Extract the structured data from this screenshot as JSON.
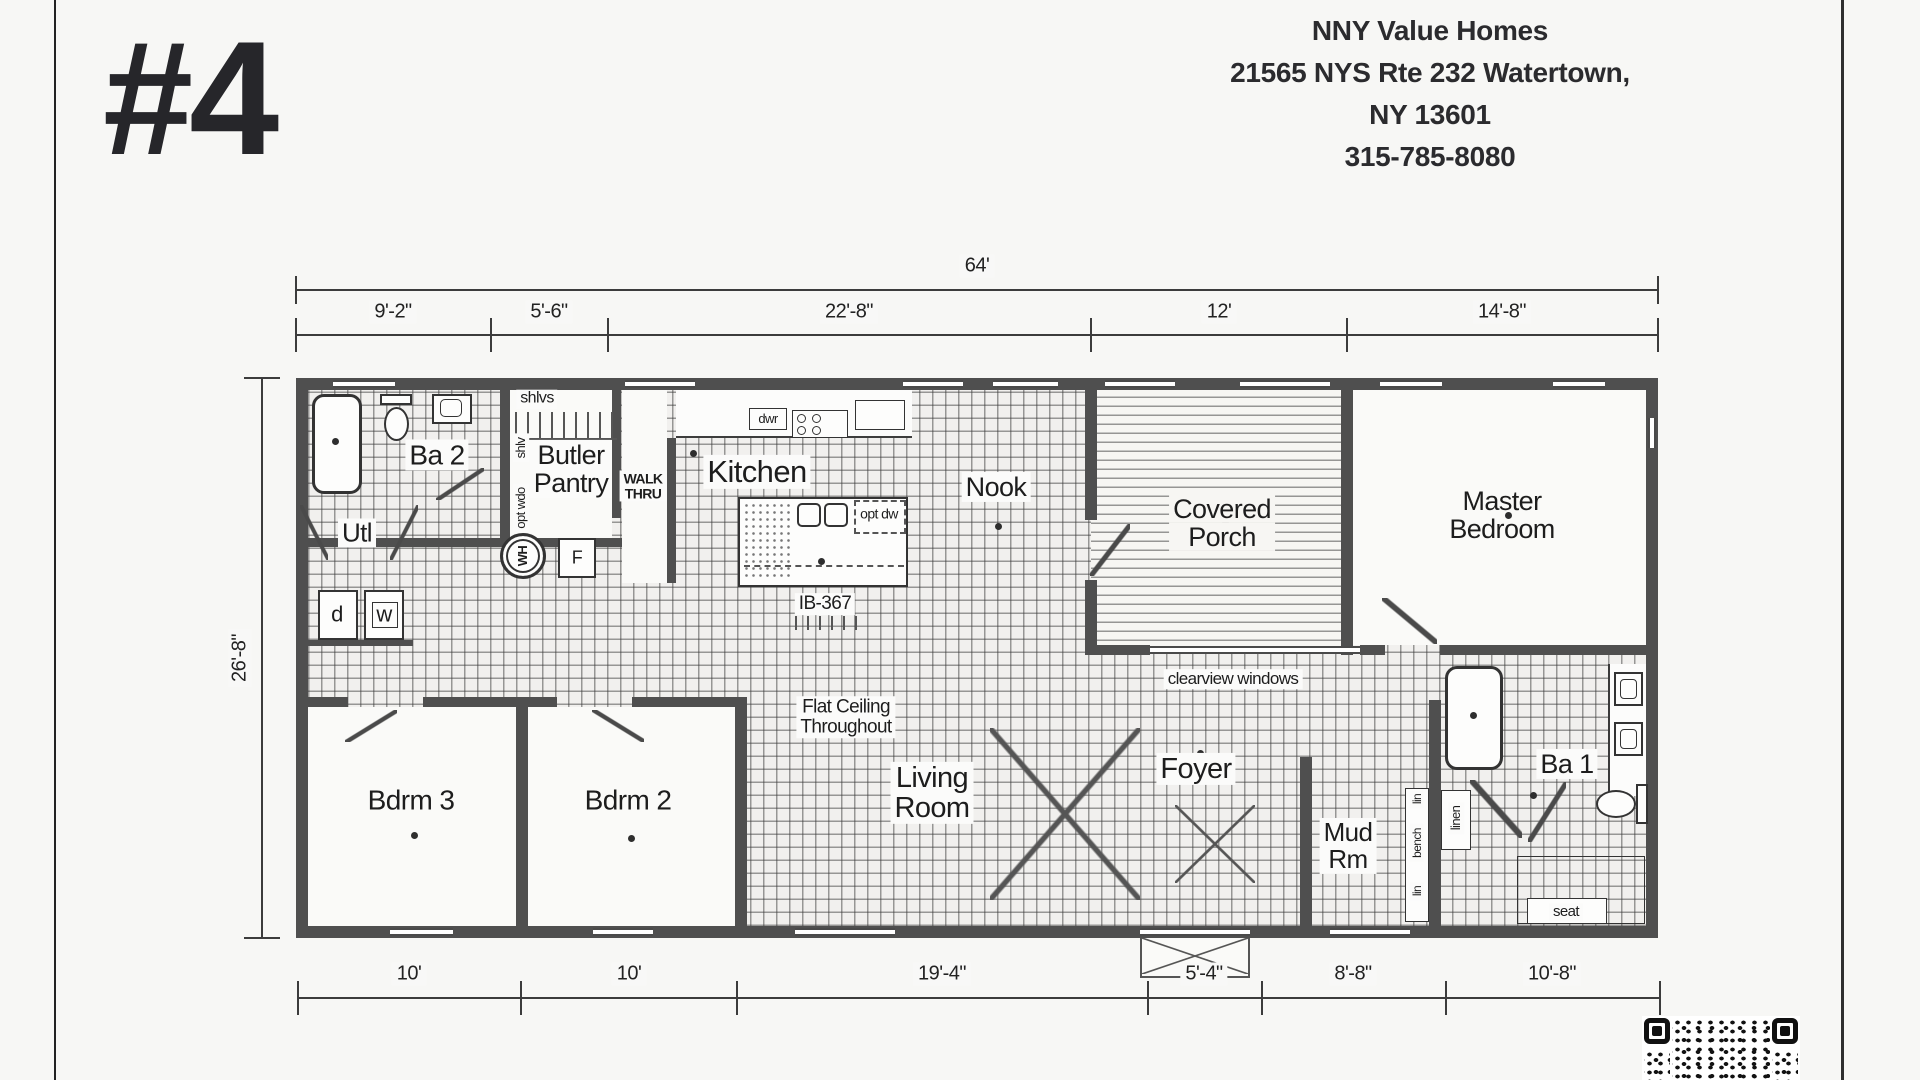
{
  "page": {
    "plan_number": "#4"
  },
  "header": {
    "company": "NNY Value Homes",
    "address_line1": "21565 NYS Rte 232 Watertown,",
    "address_line2": "NY 13601",
    "phone": "315-785-8080"
  },
  "dimensions": {
    "total_width": "64'",
    "top_segments": [
      "9'-2\"",
      "5'-6\"",
      "22'-8\"",
      "12'",
      "14'-8\""
    ],
    "height": "26'-8\"",
    "bottom_segments": [
      "10'",
      "10'",
      "19'-4\"",
      "5'-4\"",
      "8'-8\"",
      "10'-8\""
    ]
  },
  "rooms": {
    "ba2": "Ba 2",
    "utl": "Utl",
    "butler_l1": "Butler",
    "butler_l2": "Pantry",
    "kitchen": "Kitchen",
    "nook": "Nook",
    "porch_l1": "Covered",
    "porch_l2": "Porch",
    "master_l1": "Master",
    "master_l2": "Bedroom",
    "bdrm3": "Bdrm 3",
    "bdrm2": "Bdrm 2",
    "living_l1": "Living",
    "living_l2": "Room",
    "foyer": "Foyer",
    "mud_l1": "Mud",
    "mud_l2": "Rm",
    "ba1": "Ba 1"
  },
  "annotations": {
    "shlvs": "shlvs",
    "shlv": "shlv",
    "opt_wdo": "opt wdo",
    "walk_l1": "WALK",
    "walk_l2": "THRU",
    "dwr": "dwr",
    "opt_dw": "opt dw",
    "model": "IB-367",
    "flat_l1": "Flat Ceiling",
    "flat_l2": "Throughout",
    "clearview": "clearview windows",
    "lin1": "lin",
    "bench": "bench",
    "lin2": "lin",
    "linen": "linen",
    "seat": "seat",
    "dryer": "d",
    "washer": "w",
    "water_heater": "WH",
    "fridge": "F"
  }
}
